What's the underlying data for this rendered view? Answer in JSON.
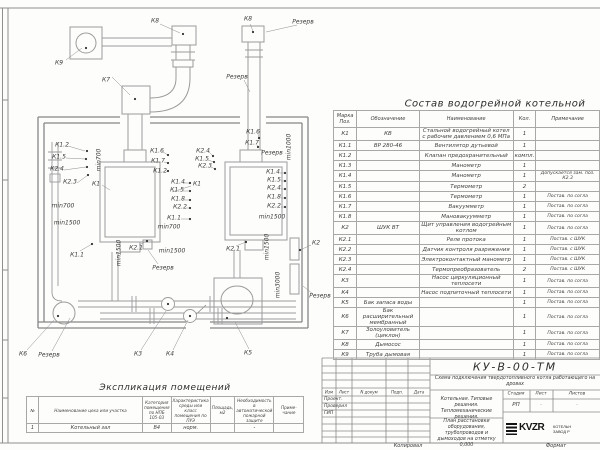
{
  "composition_table": {
    "title": "Состав водогрейной котельной",
    "columns": [
      "Марка Поз.",
      "Обозначение",
      "Наименование",
      "Кол.",
      "Примечание"
    ],
    "rows": [
      {
        "m": "К1",
        "d": "КВ",
        "n": "Стальной водогрейный котел с рабочим давлением 0,6 МПа",
        "q": "1",
        "p": ""
      },
      {
        "m": "К1.1",
        "d": "ВР 280-46",
        "n": "Вентилятор дутьевой",
        "q": "1",
        "p": ""
      },
      {
        "m": "К1.2",
        "d": "",
        "n": "Клапан предохранительный",
        "q": "компл.",
        "p": ""
      },
      {
        "m": "К1.3",
        "d": "",
        "n": "Манометр",
        "q": "1",
        "p": ""
      },
      {
        "m": "К1.4",
        "d": "",
        "n": "Манометр",
        "q": "1",
        "p": "Допускается зам. поз. К2.3"
      },
      {
        "m": "К1.5",
        "d": "",
        "n": "Термометр",
        "q": "2",
        "p": ""
      },
      {
        "m": "К1.6",
        "d": "",
        "n": "Термометр",
        "q": "1",
        "p": "Постав. по согла"
      },
      {
        "m": "К1.7",
        "d": "",
        "n": "Вакуумметр",
        "q": "1",
        "p": "Постав. по согла"
      },
      {
        "m": "К1.8",
        "d": "",
        "n": "Мановакуумметр",
        "q": "1",
        "p": "Постав. по согла"
      },
      {
        "m": "К2",
        "d": "ШУК ВТ",
        "n": "Щит управления водогрейным котлом",
        "q": "1",
        "p": "Постав. по согла"
      },
      {
        "m": "К2.1",
        "d": "",
        "n": "Реле протока",
        "q": "1",
        "p": "Постав. с ШУК"
      },
      {
        "m": "К2.2",
        "d": "",
        "n": "Датчик контроля разряжения",
        "q": "1",
        "p": "Постав. с ШУК"
      },
      {
        "m": "К2.3",
        "d": "",
        "n": "Электроконтактный манометр",
        "q": "1",
        "p": "Постав. с ШУК"
      },
      {
        "m": "К2.4",
        "d": "",
        "n": "Термопреобразователь",
        "q": "2",
        "p": "Постав. с ШУК"
      },
      {
        "m": "К3",
        "d": "",
        "n": "Насос циркуляционный теплосети",
        "q": "1",
        "p": "Постав. по согла"
      },
      {
        "m": "К4",
        "d": "",
        "n": "Насос подпиточный теплосети",
        "q": "1",
        "p": "Постав. по согла"
      },
      {
        "m": "К5",
        "d": "Бак запаса воды",
        "n": "",
        "q": "1",
        "p": "Постав. по согла"
      },
      {
        "m": "К6",
        "d": "Бак расширительный мембранный",
        "n": "",
        "q": "1",
        "p": "Постав. по согла"
      },
      {
        "m": "К7",
        "d": "Золоуловитель (циклон)",
        "n": "",
        "q": "1",
        "p": "Постав. по согла"
      },
      {
        "m": "К8",
        "d": "Дымосос",
        "n": "",
        "q": "1",
        "p": "Постав. по согла"
      },
      {
        "m": "К9",
        "d": "Труба дымовая",
        "n": "",
        "q": "1",
        "p": "Постав. по согла"
      }
    ]
  },
  "explication_table": {
    "title": "Экспликация помещений",
    "columns": [
      "№",
      "Наименование цеха или участка",
      "Категория помещения по НПБ 105-03",
      "Характеристика среды или класс помещения по ПУЭ",
      "Площадь, м2",
      "Необходимость в автоматической пожарной защите",
      "Приме- чание"
    ],
    "rows": [
      [
        "1",
        "Котельный зал",
        "В4",
        "норм.",
        "",
        "-",
        ""
      ]
    ]
  },
  "plan": {
    "labels": [
      {
        "t": "К9",
        "x": 59,
        "y": 63
      },
      {
        "t": "К8",
        "x": 155,
        "y": 21
      },
      {
        "t": "К8",
        "x": 248,
        "y": 19
      },
      {
        "t": "Резерв",
        "x": 303,
        "y": 22
      },
      {
        "t": "К7",
        "x": 106,
        "y": 80
      },
      {
        "t": "Резерв",
        "x": 237,
        "y": 77
      },
      {
        "t": "К1.2",
        "x": 62,
        "y": 145
      },
      {
        "t": "К1.5",
        "x": 59,
        "y": 157
      },
      {
        "t": "К2.4",
        "x": 57,
        "y": 169
      },
      {
        "t": "К2.3",
        "x": 70,
        "y": 182
      },
      {
        "t": "К1",
        "x": 96,
        "y": 184
      },
      {
        "t": "min700",
        "x": 99,
        "y": 160,
        "r": -90
      },
      {
        "t": "К1.6",
        "x": 157,
        "y": 151
      },
      {
        "t": "К1.7",
        "x": 158,
        "y": 161
      },
      {
        "t": "К1.2",
        "x": 160,
        "y": 171
      },
      {
        "t": "К2.4",
        "x": 203,
        "y": 151
      },
      {
        "t": "К1.5",
        "x": 202,
        "y": 159
      },
      {
        "t": "К2.3",
        "x": 205,
        "y": 166
      },
      {
        "t": "К1.6",
        "x": 253,
        "y": 132
      },
      {
        "t": "К1.7",
        "x": 252,
        "y": 143
      },
      {
        "t": "Резерв",
        "x": 272,
        "y": 153
      },
      {
        "t": "min1000",
        "x": 289,
        "y": 147,
        "r": -90
      },
      {
        "t": "К1.4",
        "x": 178,
        "y": 182
      },
      {
        "t": "К1",
        "x": 197,
        "y": 184
      },
      {
        "t": "К1.5",
        "x": 177,
        "y": 190
      },
      {
        "t": "К1.8",
        "x": 178,
        "y": 199
      },
      {
        "t": "К2.2",
        "x": 180,
        "y": 207
      },
      {
        "t": "К1.1",
        "x": 174,
        "y": 218
      },
      {
        "t": "min700",
        "x": 169,
        "y": 227
      },
      {
        "t": "К1.4",
        "x": 273,
        "y": 172
      },
      {
        "t": "К1.5",
        "x": 274,
        "y": 180
      },
      {
        "t": "К2.4",
        "x": 274,
        "y": 188
      },
      {
        "t": "К1.8",
        "x": 274,
        "y": 197
      },
      {
        "t": "К2.2",
        "x": 274,
        "y": 206
      },
      {
        "t": "min1500",
        "x": 272,
        "y": 217
      },
      {
        "t": "min700",
        "x": 63,
        "y": 206
      },
      {
        "t": "min1500",
        "x": 67,
        "y": 223
      },
      {
        "t": "К1.1",
        "x": 77,
        "y": 255
      },
      {
        "t": "min1500",
        "x": 119,
        "y": 253,
        "r": -90
      },
      {
        "t": "К2.1",
        "x": 136,
        "y": 248
      },
      {
        "t": "min1500",
        "x": 172,
        "y": 251
      },
      {
        "t": "К2.1",
        "x": 233,
        "y": 249
      },
      {
        "t": "Резерв",
        "x": 163,
        "y": 268
      },
      {
        "t": "min1500",
        "x": 267,
        "y": 247,
        "r": -90
      },
      {
        "t": "min3000",
        "x": 278,
        "y": 285,
        "r": -90
      },
      {
        "t": "К2",
        "x": 316,
        "y": 243
      },
      {
        "t": "Резерв",
        "x": 320,
        "y": 296
      },
      {
        "t": "К6",
        "x": 23,
        "y": 354
      },
      {
        "t": "Резерв",
        "x": 49,
        "y": 355
      },
      {
        "t": "К3",
        "x": 138,
        "y": 354
      },
      {
        "t": "К4",
        "x": 170,
        "y": 354
      },
      {
        "t": "К5",
        "x": 248,
        "y": 353
      }
    ]
  },
  "title_block": {
    "doc_number": "КУ-В-00-ТМ",
    "doc_title": "Схема подключения твердотопливного котла работающего на дровах",
    "project_name": "Котельная. Типовые решения. Тепломеханические решения.",
    "sheet_name": "План расстановки оборудования, трубопроводов и дымоходов на отметку 0,000",
    "rev_headers": [
      "Изм",
      "Лист",
      "N докум",
      "Подп.",
      "Дата"
    ],
    "roles": [
      "Проект.",
      "Проверил",
      "ГИП"
    ],
    "stage_label": "Стадия",
    "sheet_label": "Лист",
    "sheets_label": "Листов",
    "stage_value": "РП",
    "sheet_value": "-",
    "sheets_value": "-",
    "logo_text": "KVZR",
    "company_line1": "КОТЕЛЬН",
    "company_line2": "ЗАВОД Р"
  },
  "sheet": {
    "bottom_left_label": "Копировал",
    "bottom_right_label": "Формат",
    "line_color": "#9b9b9b",
    "wall_color": "#8a8a8a",
    "text_color": "#3c3c3c"
  }
}
